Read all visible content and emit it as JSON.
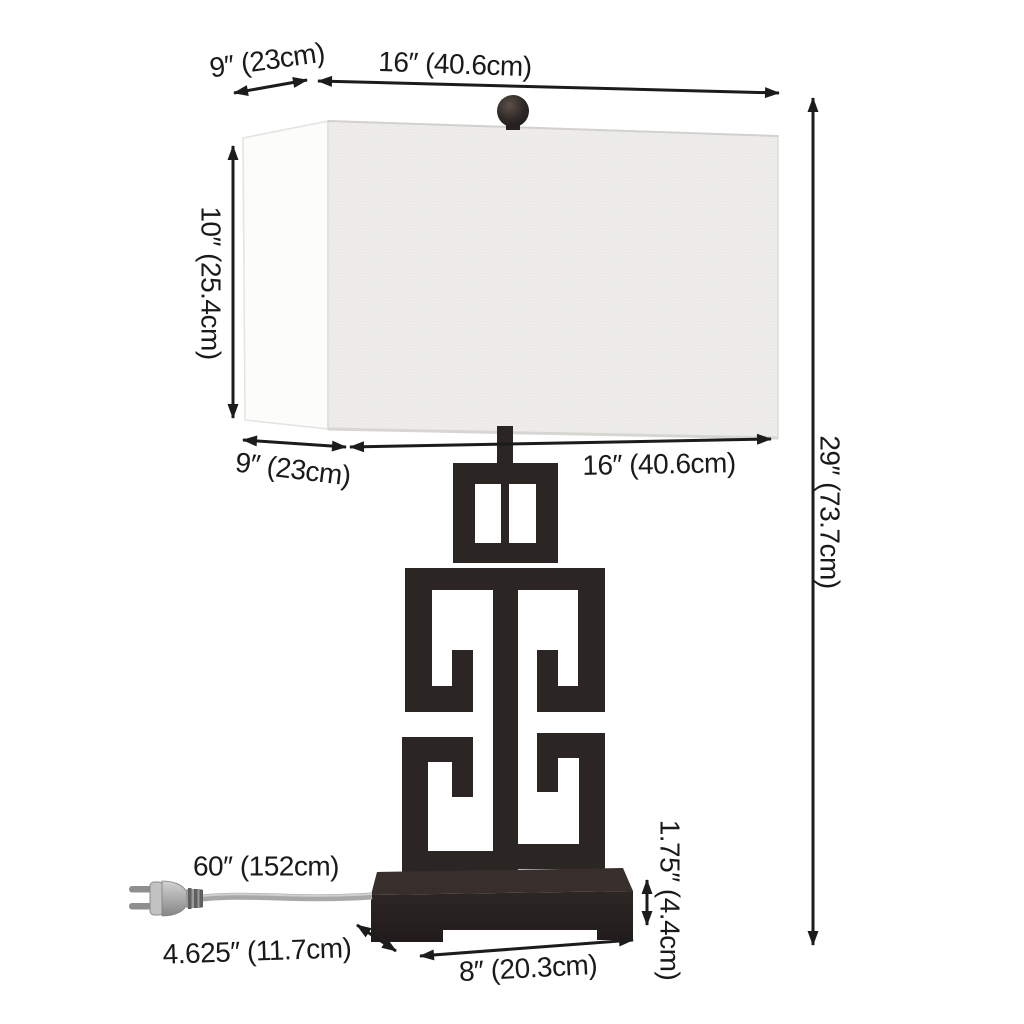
{
  "page": {
    "background": "#ffffff"
  },
  "diagram": {
    "kind": "product-dimension-diagram",
    "subject": "greek-key-table-lamp-with-rectangular-shade",
    "colors": {
      "line": "#1c1c1c",
      "text": "#1a1a1a",
      "lamp_body": "#2b2524",
      "base_top_face": "#382f2c",
      "base_front_face": "#262120",
      "shade_front": "#efeeec",
      "shade_side": "#fcfcfb",
      "finial": "#2e2826",
      "cord": "#a8a8a8",
      "plug": "#b5b5b5"
    },
    "labels": {
      "shade_top_depth": "9″ (23cm)",
      "shade_top_width": "16″ (40.6cm)",
      "shade_height": "10″ (25.4cm)",
      "shade_bottom_depth": "9″ (23cm)",
      "shade_bottom_width": "16″ (40.6cm)",
      "total_height": "29″ (73.7cm)",
      "cord_length": "60″ (152cm)",
      "base_depth": "4.625″ (11.7cm)",
      "base_width": "8″ (20.3cm)",
      "base_height": "1.75″ (4.4cm)"
    }
  }
}
